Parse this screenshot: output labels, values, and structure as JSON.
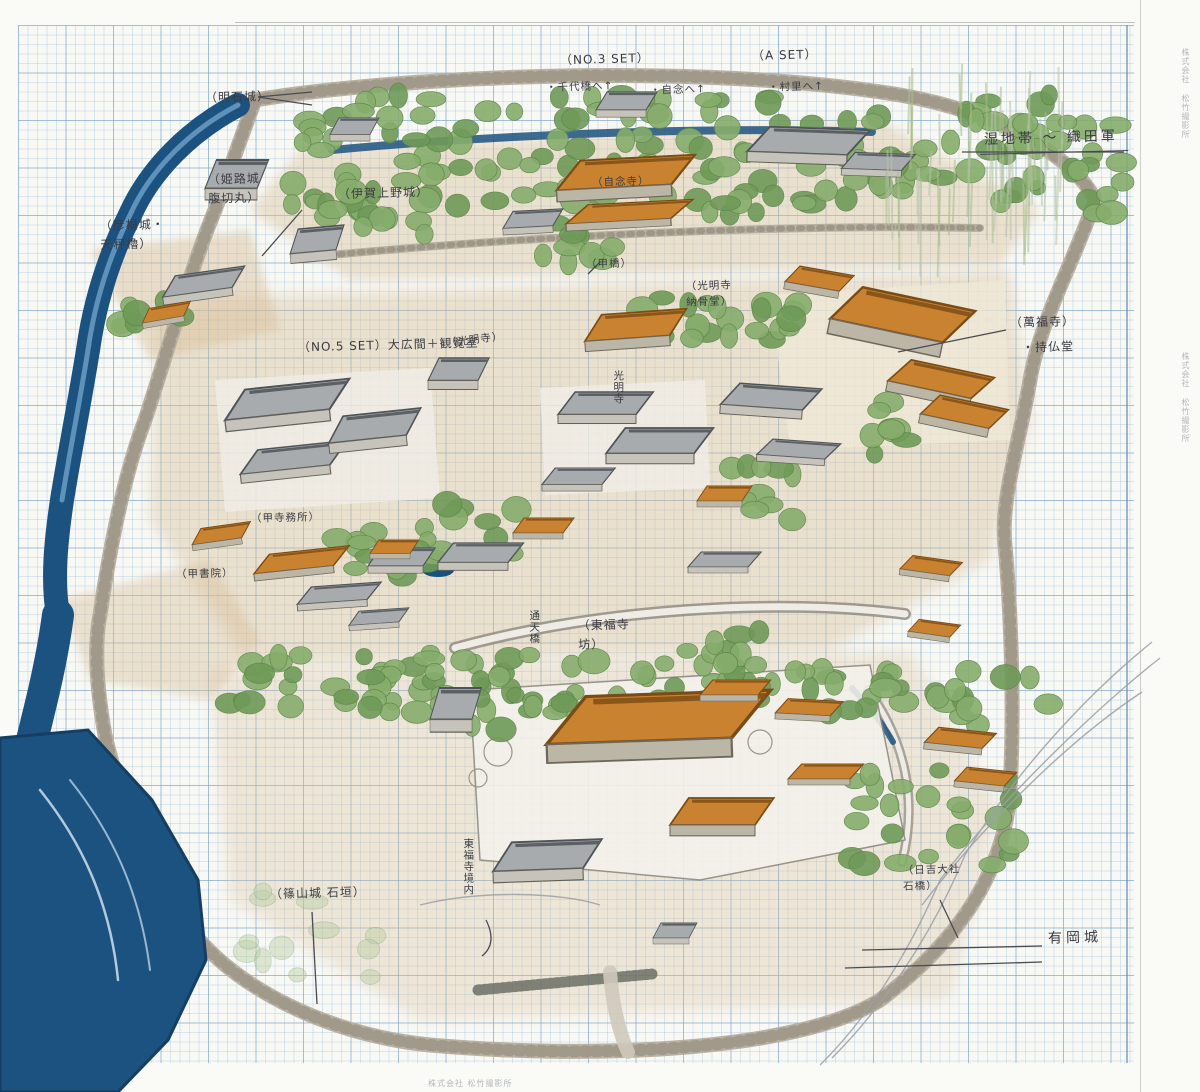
{
  "map": {
    "labels": {
      "akashi": "（明石城）",
      "no3set": "（NO.3 SET）",
      "no3_item1": "・千代橋へ↑",
      "no3_item2": "・自念へ↑",
      "aset": "（A SET）",
      "aset_item1": "・村里へ↑",
      "wetland": "湿地帯 〜 織田軍",
      "himeji": "（姫路城\n腹切丸）",
      "hikone": "（彦根城・\n天秤櫓）",
      "iga": "（伊賀上野城）",
      "jinenji": "（自念寺）",
      "kobashi": "（甲橋）",
      "komyoji_nokotsudo": "（光明寺\n納骨堂）",
      "manpukuji": "（萬福寺）",
      "jibutsudo": "・持仏堂",
      "no5set": "（NO.5 SET）大広間＋観覧室",
      "komyoji": "（光明寺）",
      "komyoji_v": "光明寺",
      "ko_jimusho": "（甲寺務所）",
      "ko_shoin": "（甲書院）",
      "tsutenkyo": "通天橋",
      "tofukuji_bo": "（東福寺\n坊）",
      "sasayama": "（篠山城 石垣）",
      "tofukuji_keidai": "東福寺境内",
      "hiyoshi": "（日吉大社\n石橋）",
      "arioka": "有岡城"
    },
    "margin_print": "株式会社 松竹撮影所",
    "colors": {
      "roof_orange": "#c9822f",
      "water_blue": "#1c5280",
      "tree_green": "#86ad6c",
      "grid_blue": "#9cc3de",
      "stone_grey": "#b5ae9f",
      "pencil": "#4a4a52"
    }
  }
}
